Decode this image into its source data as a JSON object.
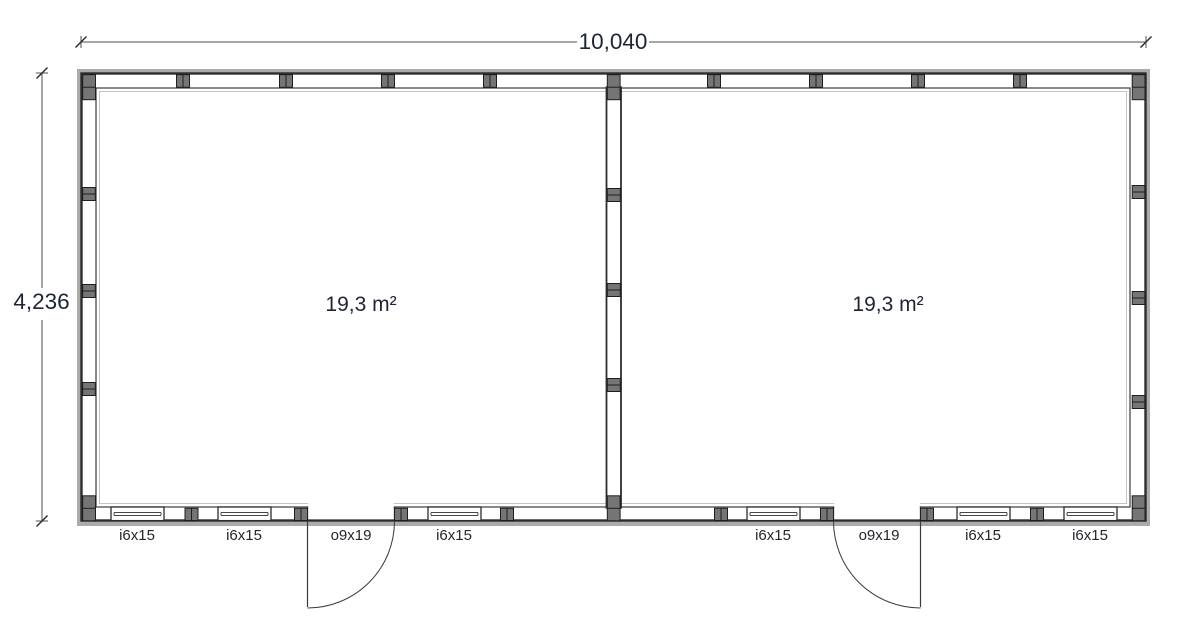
{
  "dimensions": {
    "width_label": "10,040",
    "height_label": "4,236"
  },
  "rooms": [
    {
      "area_label": "19,3 m²"
    },
    {
      "area_label": "19,3 m²"
    }
  ],
  "openings": [
    {
      "type": "window",
      "label": "i6x15"
    },
    {
      "type": "window",
      "label": "i6x15"
    },
    {
      "type": "door",
      "label": "o9x19"
    },
    {
      "type": "window",
      "label": "i6x15"
    },
    {
      "type": "window",
      "label": "i6x15"
    },
    {
      "type": "door",
      "label": "o9x19"
    },
    {
      "type": "window",
      "label": "i6x15"
    },
    {
      "type": "window",
      "label": "i6x15"
    }
  ],
  "colors": {
    "line": "#2d2d2d",
    "text": "#1d2533",
    "stud": "#757575",
    "exterior_band": "#ababab",
    "label_text": "#23262b"
  }
}
